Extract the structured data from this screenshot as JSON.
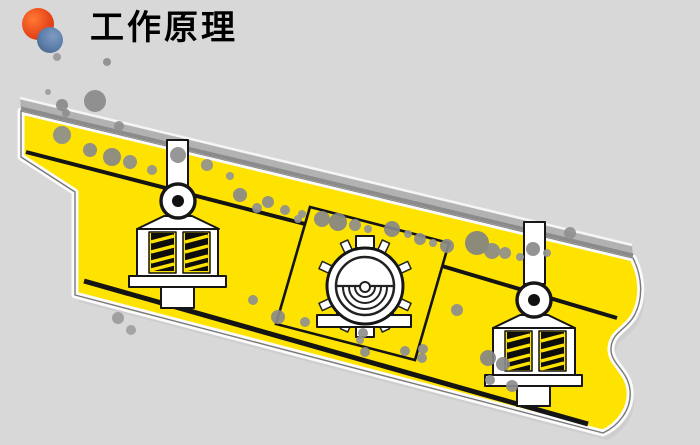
{
  "header": {
    "title": "工作原理"
  },
  "logo": {
    "orange_circle": "#e8481a",
    "blue_circle": "#5b7ca8"
  },
  "colors": {
    "background": "#d8d8d8",
    "body_yellow": "#ffe300",
    "deck_gray": "#b2b2b2",
    "deck_shadow": "#8b8b8b",
    "deck_highlight": "#f5f5f5",
    "line_black": "#141414",
    "body_shadow": "#c6c6c6",
    "logo_orange": "#e8481a",
    "logo_blue": "#5b7ca8"
  },
  "diagram": {
    "particles": [
      [
        57,
        57,
        4,
        "#9a9a9a"
      ],
      [
        107,
        62,
        4,
        "#8e8e8e"
      ],
      [
        48,
        92,
        3,
        "#9c9c9c"
      ],
      [
        62,
        105,
        6,
        "#8a8a8a"
      ],
      [
        66,
        113,
        4,
        "#8e8e8e"
      ],
      [
        95,
        101,
        11,
        "#8a8a8a"
      ],
      [
        119,
        126,
        5,
        "#909090"
      ],
      [
        62,
        135,
        9,
        "#8d8d8d"
      ],
      [
        90,
        150,
        7,
        "#8a8a8a"
      ],
      [
        112,
        157,
        9,
        "#878787"
      ],
      [
        130,
        162,
        7,
        "#8d8d8d"
      ],
      [
        152,
        170,
        5,
        "#939393"
      ],
      [
        178,
        155,
        8,
        "#8e8e8e"
      ],
      [
        207,
        165,
        6,
        "#919191"
      ],
      [
        230,
        176,
        4,
        "#959595"
      ],
      [
        240,
        195,
        7,
        "#898989"
      ],
      [
        257,
        208,
        5,
        "#8f8f8f"
      ],
      [
        268,
        202,
        6,
        "#8b8b8b"
      ],
      [
        285,
        210,
        5,
        "#8f8f8f"
      ],
      [
        302,
        214,
        4,
        "#939393"
      ],
      [
        322,
        219,
        8,
        "#888888"
      ],
      [
        338,
        222,
        9,
        "#848484"
      ],
      [
        355,
        225,
        6,
        "#8d8d8d"
      ],
      [
        368,
        229,
        4,
        "#929292"
      ],
      [
        392,
        229,
        8,
        "#878787"
      ],
      [
        408,
        234,
        4,
        "#929292"
      ],
      [
        420,
        239,
        6,
        "#8c8c8c"
      ],
      [
        433,
        243,
        4,
        "#949494"
      ],
      [
        447,
        246,
        7,
        "#898989"
      ],
      [
        477,
        243,
        12,
        "#828282"
      ],
      [
        492,
        251,
        8,
        "#8a8a8a"
      ],
      [
        505,
        253,
        6,
        "#8f8f8f"
      ],
      [
        520,
        257,
        4,
        "#949494"
      ],
      [
        533,
        249,
        7,
        "#8a8a8a"
      ],
      [
        547,
        253,
        4,
        "#959595"
      ],
      [
        570,
        233,
        6,
        "#909090"
      ],
      [
        298,
        219,
        4,
        "#949494"
      ],
      [
        253,
        300,
        5,
        "#8f8f8f"
      ],
      [
        278,
        317,
        7,
        "#8a8a8a"
      ],
      [
        305,
        322,
        5,
        "#909090"
      ],
      [
        363,
        333,
        5,
        "#8f8f8f"
      ],
      [
        365,
        352,
        5,
        "#8d8d8d"
      ],
      [
        405,
        351,
        5,
        "#8e8e8e"
      ],
      [
        422,
        358,
        5,
        "#8e8e8e"
      ],
      [
        457,
        310,
        6,
        "#8d8d8d"
      ],
      [
        488,
        358,
        8,
        "#868686"
      ],
      [
        503,
        364,
        7,
        "#898989"
      ],
      [
        490,
        380,
        5,
        "#909090"
      ],
      [
        512,
        386,
        6,
        "#8c8c8c"
      ],
      [
        360,
        340,
        4,
        "#949494"
      ],
      [
        423,
        349,
        5,
        "#909090"
      ],
      [
        118,
        318,
        6,
        "#9b9b9b"
      ],
      [
        131,
        330,
        5,
        "#9e9e9e"
      ]
    ]
  }
}
